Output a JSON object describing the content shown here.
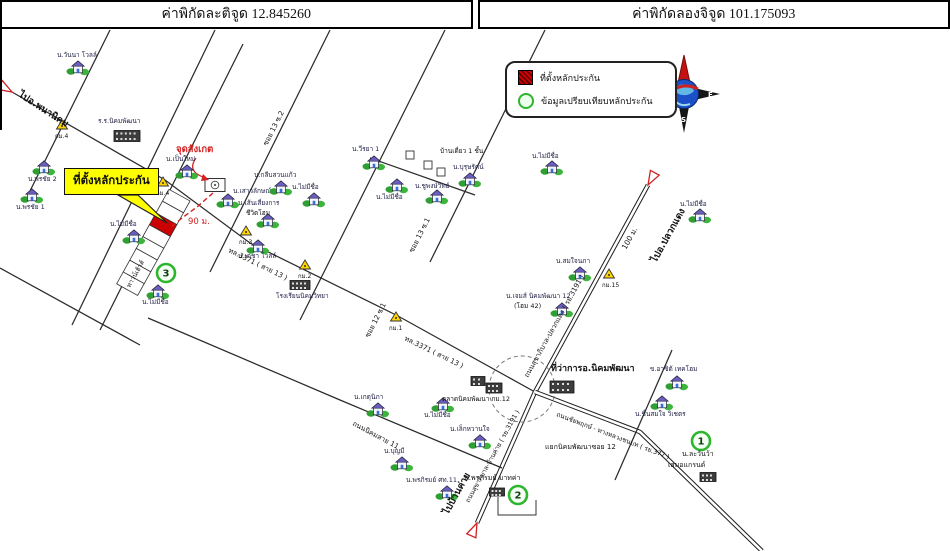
{
  "header": {
    "latitude": "ค่าพิกัดละติจูด 12.845260",
    "longitude": "ค่าพิกัดลองจิจูด 101.175093"
  },
  "legend": {
    "items": [
      {
        "symbol": "collateral-red-square",
        "label": "ที่ตั้งหลักประกัน"
      },
      {
        "symbol": "comparison-green-circle",
        "label": "ข้อมูลเปรียบเทียบหลักประกัน"
      }
    ]
  },
  "callout": {
    "text": "ที่ตั้งหลักประกัน",
    "pointer": [
      [
        118,
        195
      ],
      [
        138,
        195
      ],
      [
        167,
        223
      ]
    ]
  },
  "compass": {
    "west": "W",
    "east": "E",
    "south": "S"
  },
  "colors": {
    "collateral": "#cc0000",
    "highlight": "#ffff00",
    "comparison": "#2db52d",
    "landmark_red": "#d42222"
  },
  "map": {
    "roads": [
      {
        "id": "thl-3371",
        "points": [
          [
            12,
            92
          ],
          [
            165,
            180
          ],
          [
            250,
            243
          ],
          [
            398,
            316
          ],
          [
            535,
            392
          ]
        ],
        "double": false
      },
      {
        "id": "ry-3191",
        "points": [
          [
            648,
            185
          ],
          [
            535,
            392
          ],
          [
            477,
            523
          ]
        ],
        "double": true
      },
      {
        "id": "ry-377",
        "points": [
          [
            535,
            392
          ],
          [
            640,
            432
          ],
          [
            762,
            551
          ]
        ],
        "double": true
      },
      {
        "id": "soi-1",
        "points": [
          [
            110,
            30
          ],
          [
            28,
            195
          ]
        ],
        "double": false
      },
      {
        "id": "soi-2",
        "points": [
          [
            215,
            30
          ],
          [
            72,
            325
          ]
        ],
        "double": false
      },
      {
        "id": "soi-2b",
        "points": [
          [
            243,
            44
          ],
          [
            100,
            330
          ]
        ],
        "double": false
      },
      {
        "id": "soi-3",
        "points": [
          [
            330,
            30
          ],
          [
            210,
            272
          ]
        ],
        "double": false
      },
      {
        "id": "soi-4",
        "points": [
          [
            445,
            30
          ],
          [
            300,
            320
          ]
        ],
        "double": false
      },
      {
        "id": "soi-5",
        "points": [
          [
            545,
            30
          ],
          [
            430,
            262
          ]
        ],
        "double": false
      },
      {
        "id": "connector",
        "points": [
          [
            370,
            158
          ],
          [
            475,
            195
          ]
        ],
        "double": false
      },
      {
        "id": "lower-road-a",
        "points": [
          [
            0,
            268
          ],
          [
            140,
            345
          ]
        ],
        "double": false
      },
      {
        "id": "nikhom-11",
        "points": [
          [
            148,
            318
          ],
          [
            340,
            400
          ],
          [
            502,
            468
          ]
        ],
        "double": false
      },
      {
        "id": "soi-7",
        "points": [
          [
            672,
            350
          ],
          [
            615,
            480
          ]
        ],
        "double": false
      }
    ],
    "junction_circle": {
      "x": 522,
      "y": 389,
      "r": 33
    },
    "plot_strip": {
      "x": 190,
      "y": 201,
      "rot": 119,
      "cell_w": 13.5,
      "cell_h": 24,
      "count": 8,
      "red_index": 2
    },
    "red_path": [
      [
        213,
        193
      ],
      [
        197,
        207
      ],
      [
        182,
        218
      ],
      [
        171,
        227
      ]
    ],
    "landmark": {
      "x": 215,
      "y": 185,
      "arrow": "M196,158 Q186,172 206,178",
      "arrow_head": [
        [
          203,
          174
        ],
        [
          209,
          180
        ],
        [
          201,
          181
        ]
      ]
    },
    "detached_squares": [
      [
        410,
        155
      ],
      [
        428,
        165
      ],
      [
        441,
        172
      ]
    ],
    "bracket": [
      [
        498,
        497
      ],
      [
        498,
        515
      ],
      [
        536,
        515
      ],
      [
        536,
        500
      ]
    ],
    "km_markers": [
      {
        "x": 62,
        "y": 126,
        "label": "กม.4"
      },
      {
        "x": 163,
        "y": 183,
        "label": "กม.4"
      },
      {
        "x": 246,
        "y": 232,
        "label": "กม.3"
      },
      {
        "x": 305,
        "y": 266,
        "label": "กม.2"
      },
      {
        "x": 396,
        "y": 318,
        "label": "กม.1"
      },
      {
        "x": 609,
        "y": 275,
        "label": "กม.15"
      }
    ],
    "number_circles": [
      {
        "n": "3",
        "x": 166,
        "y": 273
      },
      {
        "n": "1",
        "x": 701,
        "y": 441
      },
      {
        "n": "2",
        "x": 518,
        "y": 495
      }
    ],
    "end_arrows": [
      {
        "x": 12,
        "y": 92,
        "rot": -150
      },
      {
        "x": 648,
        "y": 185,
        "rot": -61
      },
      {
        "x": 477,
        "y": 523,
        "rot": 114
      }
    ],
    "houses": [
      {
        "x": 78,
        "y": 68,
        "label": "น.วันนา โวลล์",
        "lx": 57,
        "ly": 57
      },
      {
        "x": 44,
        "y": 168,
        "label": "น.พรชัย 2",
        "lx": 28,
        "ly": 181
      },
      {
        "x": 32,
        "y": 196,
        "label": "น.พรชัย 1",
        "lx": 16,
        "ly": 209
      },
      {
        "x": 134,
        "y": 237,
        "label": "น.ไม่มีชื่อ",
        "lx": 110,
        "ly": 226
      },
      {
        "x": 158,
        "y": 292,
        "label": "น.ไม่มีชื่อ",
        "lx": 142,
        "ly": 304
      },
      {
        "x": 187,
        "y": 172,
        "label": "น.เป็นใหม่",
        "lx": 166,
        "ly": 161
      },
      {
        "x": 228,
        "y": 201,
        "label": "น.เสาวลักษณ์",
        "lx": 233,
        "ly": 193
      },
      {
        "x": 281,
        "y": 188,
        "label": "น.กลีบสวนแก้ว",
        "lx": 254,
        "ly": 177
      },
      {
        "x": 314,
        "y": 200,
        "label": "น.ไม่มีชื่อ",
        "lx": 292,
        "ly": 189
      },
      {
        "x": 268,
        "y": 221,
        "label": "น.เส้นเสี่ยงการ",
        "lx": 238,
        "ly": 205
      },
      {
        "x": 374,
        "y": 163,
        "label": "น.วีรยา 1",
        "lx": 352,
        "ly": 151
      },
      {
        "x": 397,
        "y": 186,
        "label": "น.ไม่มีชื่อ",
        "lx": 376,
        "ly": 199
      },
      {
        "x": 470,
        "y": 180,
        "label": "น.บุรุษรัตน์",
        "lx": 453,
        "ly": 169
      },
      {
        "x": 437,
        "y": 197,
        "label": "น.ชูพงษ์วิทย์",
        "lx": 415,
        "ly": 188
      },
      {
        "x": 258,
        "y": 247,
        "label": "น.เดชา โวลล์",
        "lx": 238,
        "ly": 258
      },
      {
        "x": 580,
        "y": 274,
        "label": "น.สมใจนภา",
        "lx": 556,
        "ly": 263
      },
      {
        "x": 562,
        "y": 310,
        "label": "น.เจมส์ นิคมพัฒนา 12",
        "lx": 506,
        "ly": 298
      },
      {
        "x": 378,
        "y": 410,
        "label": "น.เกตุนิภา",
        "lx": 354,
        "ly": 399
      },
      {
        "x": 443,
        "y": 405,
        "label": "น.ไม่มีชื่อ",
        "lx": 424,
        "ly": 417
      },
      {
        "x": 480,
        "y": 442,
        "label": "น.เล็กหวานใจ",
        "lx": 450,
        "ly": 431
      },
      {
        "x": 402,
        "y": 464,
        "label": "น.บุญมี",
        "lx": 384,
        "ly": 453
      },
      {
        "x": 447,
        "y": 493,
        "label": "น.พรภิรมย์ ศท.11",
        "lx": 406,
        "ly": 482
      },
      {
        "x": 677,
        "y": 383,
        "label": "ข.อาซิต้ เทคโฮม",
        "lx": 650,
        "ly": 371
      },
      {
        "x": 662,
        "y": 403,
        "label": "น.ชื่นสมใจ วิเชตร",
        "lx": 635,
        "ly": 416
      },
      {
        "x": 700,
        "y": 216,
        "label": "น.ไม่มีชื่อ",
        "lx": 680,
        "ly": 206
      },
      {
        "x": 552,
        "y": 168,
        "label": "น.ไม่มีชื่อ",
        "lx": 532,
        "ly": 158
      }
    ],
    "buildings": [
      {
        "x": 127,
        "y": 136,
        "w": 26,
        "h": 11,
        "label": "ร.ร.นิคมพัฒนา",
        "lx": 98,
        "ly": 123
      },
      {
        "x": 300,
        "y": 285,
        "w": 20,
        "h": 9,
        "label": "โรงเรียนนิคมวิทยา",
        "lx": 276,
        "ly": 298
      },
      {
        "x": 562,
        "y": 387,
        "w": 24,
        "h": 12,
        "label": "",
        "lx": 0,
        "ly": 0
      },
      {
        "x": 478,
        "y": 381,
        "w": 14,
        "h": 9,
        "label": "",
        "lx": 0,
        "ly": 0
      },
      {
        "x": 494,
        "y": 388,
        "w": 16,
        "h": 10,
        "label": "",
        "lx": 0,
        "ly": 0
      },
      {
        "x": 497,
        "y": 492,
        "w": 15,
        "h": 8,
        "label": "",
        "lx": 0,
        "ly": 0
      },
      {
        "x": 708,
        "y": 477,
        "w": 16,
        "h": 9,
        "label": "",
        "lx": 0,
        "ly": 0
      }
    ],
    "labels": [
      {
        "t": "ไปอ.พนานิคม",
        "x": 18,
        "y": 96,
        "r": 33,
        "s": 9.5,
        "b": 1
      },
      {
        "t": "ไปอ.ปลวกแดง",
        "x": 656,
        "y": 263,
        "r": -61,
        "s": 9.5,
        "b": 1
      },
      {
        "t": "ไปบ้านค่าย",
        "x": 448,
        "y": 515,
        "r": -61,
        "s": 9.5,
        "b": 1
      },
      {
        "t": "100 ม.",
        "x": 626,
        "y": 250,
        "r": -61,
        "s": 7.5
      },
      {
        "t": "ถนนสุขาภิบาล-ปลวกแดง ( รย.3191 )",
        "x": 528,
        "y": 378,
        "r": -61,
        "s": 7
      },
      {
        "t": "ถนนสุขาภิบาล-บ้านค่าย ( รย.3191 )",
        "x": 469,
        "y": 503,
        "r": -61,
        "s": 6.5
      },
      {
        "t": "ทล.3371 ( สาย 13 )",
        "x": 228,
        "y": 252,
        "r": 26,
        "s": 7
      },
      {
        "t": "ทล.3371 ( สาย 13 )",
        "x": 404,
        "y": 340,
        "r": 26,
        "s": 7
      },
      {
        "t": "ซอย 13 ซ.2",
        "x": 267,
        "y": 146,
        "r": -63,
        "s": 7
      },
      {
        "t": "ซอย 13 ซ.1",
        "x": 413,
        "y": 253,
        "r": -63,
        "s": 7
      },
      {
        "t": "ซอย 12 ซ.1",
        "x": 369,
        "y": 338,
        "r": -63,
        "s": 7
      },
      {
        "t": "ถนนนิคมสาย 11",
        "x": 352,
        "y": 425,
        "r": 28,
        "s": 7
      },
      {
        "t": "ถนนชัยพฤกษ์ - ทางหลวงชนบท ( รย.377 )",
        "x": 556,
        "y": 416,
        "r": 21,
        "s": 6.5
      },
      {
        "t": "แยกนิคมพัฒนาซอย 12",
        "x": 545,
        "y": 449,
        "s": 7
      },
      {
        "t": "ที่ว่าการอ.นิคมพัฒนา",
        "x": 551,
        "y": 371,
        "s": 9,
        "b": 1
      },
      {
        "t": "ตลาดนิคมพัฒนา กม.12",
        "x": 442,
        "y": 401,
        "s": 6.5
      },
      {
        "t": "จุดสังเกต",
        "x": 176,
        "y": 152,
        "s": 9.5,
        "b": 1,
        "c": "#d42222"
      },
      {
        "t": "90 ม.",
        "x": 188,
        "y": 224,
        "s": 8.5,
        "c": "#d42222"
      },
      {
        "t": "ชีวิตโฮม",
        "x": 246,
        "y": 215,
        "s": 6.5
      },
      {
        "t": "บ้านเดี่ยว 1 ชั้น",
        "x": 440,
        "y": 153,
        "s": 6.5
      },
      {
        "t": "ทาวน์เฮ้าส์",
        "x": 130,
        "y": 288,
        "r": -61,
        "s": 6.5
      },
      {
        "t": "น.ละวันว้า",
        "x": 682,
        "y": 456,
        "s": 7
      },
      {
        "t": "เสมอแกรนด์",
        "x": 668,
        "y": 467,
        "s": 7
      },
      {
        "t": "(โฮม 42)",
        "x": 514,
        "y": 308,
        "s": 6.5
      },
      {
        "t": "น.พรภิรมย์ มาทค่า",
        "x": 464,
        "y": 480,
        "s": 7
      }
    ]
  }
}
